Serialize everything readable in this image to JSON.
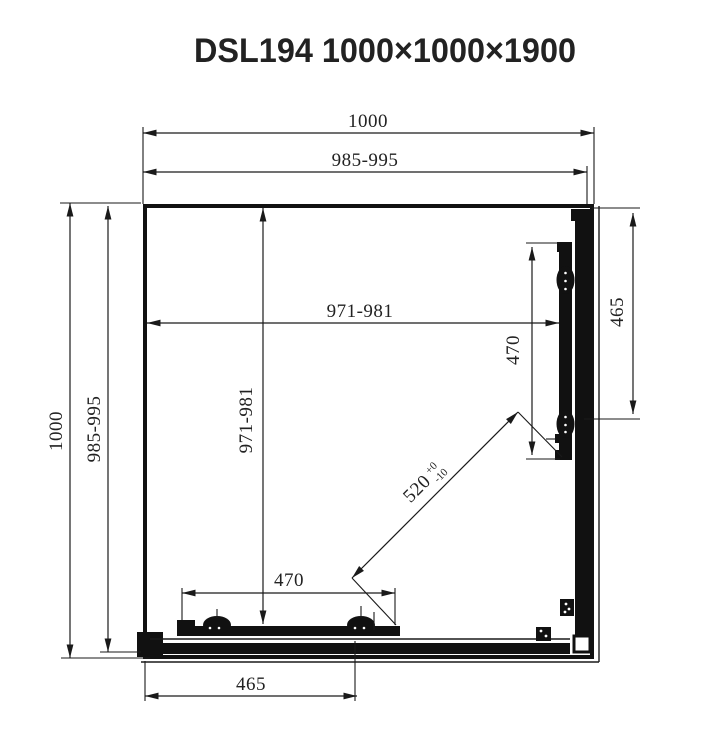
{
  "title": "DSL194 1000×1000×1900",
  "colors": {
    "line": "#1a1a1a",
    "background": "#ffffff"
  },
  "dimensions": {
    "top_outer": "1000",
    "top_inner": "985-995",
    "left_outer": "1000",
    "left_inner": "985-995",
    "inner_width": "971-981",
    "inner_depth": "971-981",
    "right_door_length": "470",
    "right_side_length": "465",
    "bottom_door_length": "470",
    "bottom_side_length": "465",
    "diagonal_opening": "520",
    "diagonal_tolerance_upper": "+0",
    "diagonal_tolerance_lower": "-10"
  }
}
